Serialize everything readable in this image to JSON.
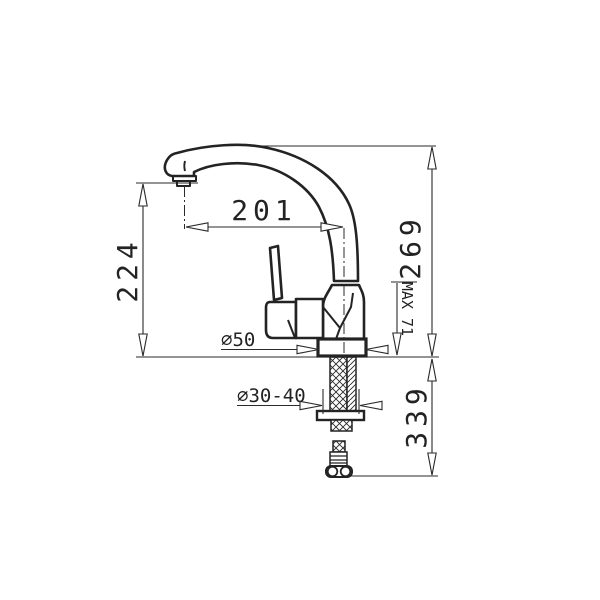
{
  "drawing": {
    "background": "#ffffff",
    "ink": "#2a2a2a",
    "labels": {
      "spout_reach": "201",
      "outlet_height": "224",
      "total_height": "269",
      "below_counter_length": "339",
      "max_deck_thickness": "MAX 71",
      "base_diameter": "∅50",
      "mounting_hole_diameter": "∅30-40"
    }
  }
}
